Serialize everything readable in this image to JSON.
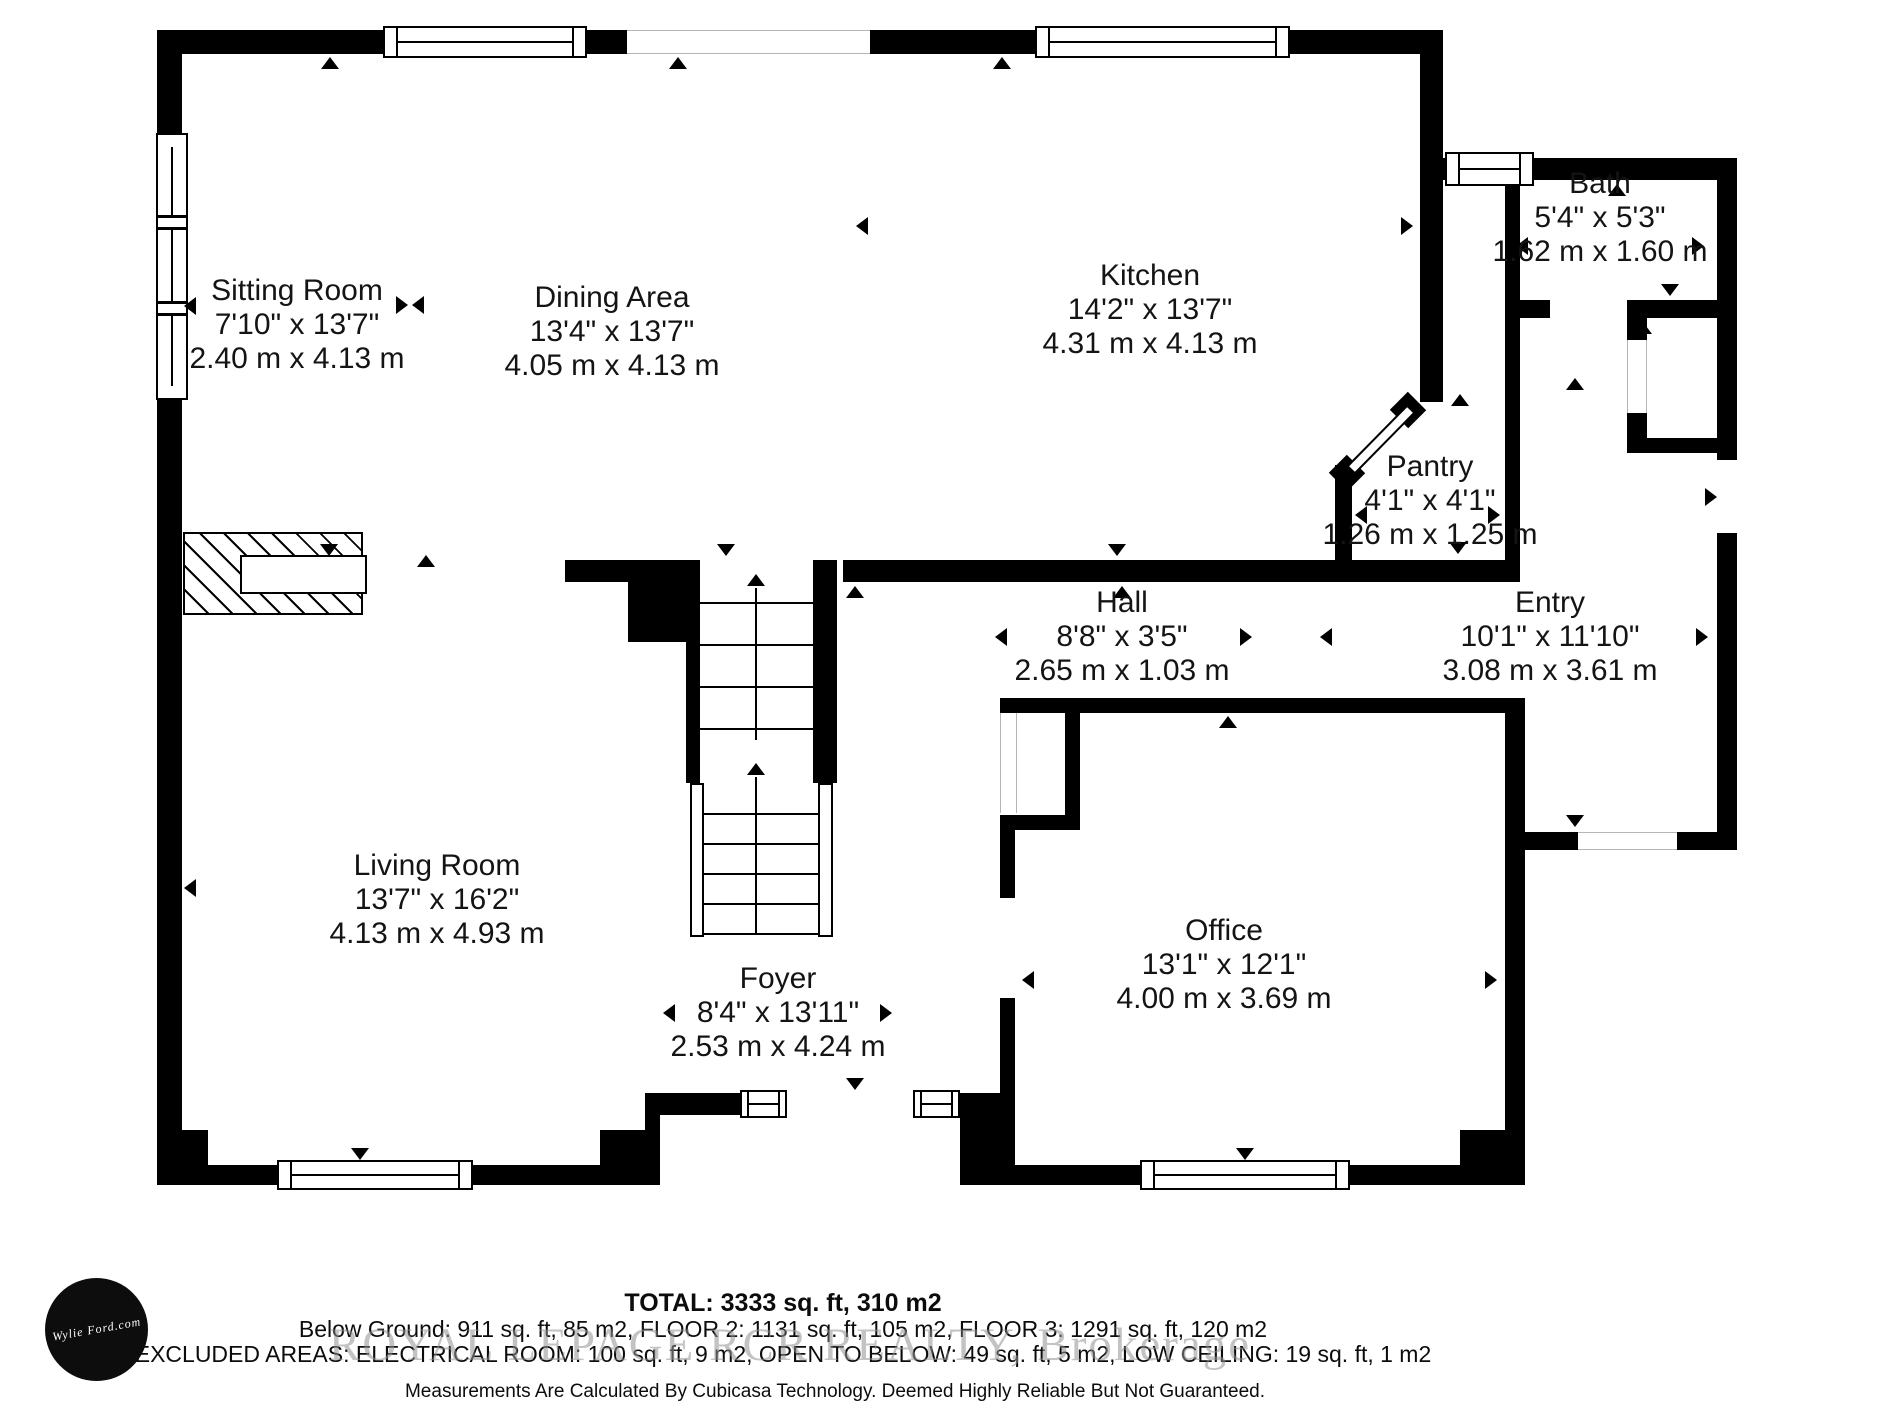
{
  "rooms": {
    "sitting": {
      "name": "Sitting Room",
      "imperial": "7'10\" x 13'7\"",
      "metric": "2.40 m x 4.13 m"
    },
    "dining": {
      "name": "Dining Area",
      "imperial": "13'4\" x 13'7\"",
      "metric": "4.05 m x 4.13 m"
    },
    "kitchen": {
      "name": "Kitchen",
      "imperial": "14'2\" x 13'7\"",
      "metric": "4.31 m x 4.13 m"
    },
    "bath": {
      "name": "Bath",
      "imperial": "5'4\" x 5'3\"",
      "metric": "1.62 m x 1.60 m"
    },
    "pantry": {
      "name": "Pantry",
      "imperial": "4'1\" x 4'1\"",
      "metric": "1.26 m x 1.25 m"
    },
    "hall": {
      "name": "Hall",
      "imperial": "8'8\" x 3'5\"",
      "metric": "2.65 m x 1.03 m"
    },
    "entry": {
      "name": "Entry",
      "imperial": "10'1\" x 11'10\"",
      "metric": "3.08 m x 3.61 m"
    },
    "office": {
      "name": "Office",
      "imperial": "13'1\" x 12'1\"",
      "metric": "4.00 m x 3.69 m"
    },
    "foyer": {
      "name": "Foyer",
      "imperial": "8'4\" x 13'11\"",
      "metric": "2.53 m x 4.24 m"
    },
    "living": {
      "name": "Living Room",
      "imperial": "13'7\" x 16'2\"",
      "metric": "4.13 m x 4.93 m"
    }
  },
  "footer": {
    "total": "TOTAL: 3333 sq. ft, 310 m2",
    "floors": "Below Ground: 911 sq. ft, 85 m2, FLOOR 2: 1131 sq. ft, 105 m2, FLOOR 3: 1291 sq. ft, 120 m2",
    "excluded": "EXCLUDED AREAS: ELECTRICAL ROOM: 100 sq. ft, 9 m2, OPEN TO BELOW: 49 sq. ft, 5 m2, LOW CEILING: 19 sq. ft, 1 m2",
    "disclaimer": "Measurements Are Calculated By Cubicasa Technology. Deemed Highly Reliable But Not Guaranteed."
  },
  "watermark": "ROYAL LEPAGE RCR REALTY, Brokerage",
  "logo_text": "Wylie Ford.com",
  "colors": {
    "wall": "#000000",
    "background": "#ffffff",
    "watermark": "#919191",
    "opening_outline": "#b5b5b5"
  }
}
